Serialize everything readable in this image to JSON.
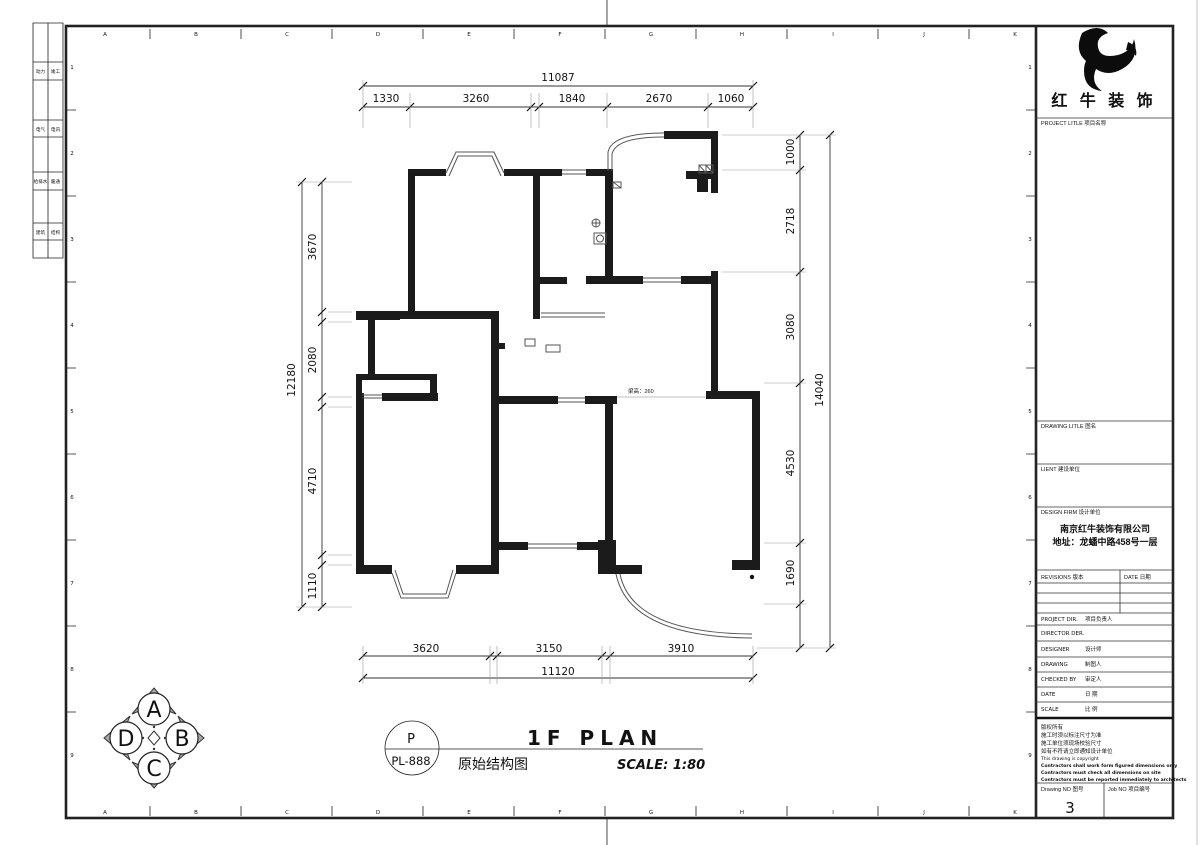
{
  "frame": {
    "letters": [
      "A",
      "B",
      "C",
      "D",
      "E",
      "F",
      "G",
      "H",
      "I",
      "J",
      "K"
    ],
    "rows": [
      "1",
      "2",
      "3",
      "4",
      "5",
      "6",
      "7",
      "8",
      "9"
    ],
    "strip": [
      [
        "动力",
        "竣工"
      ],
      [
        "电气",
        "电讯"
      ],
      [
        "给排水",
        "暖通"
      ],
      [
        "建筑",
        "结构"
      ]
    ]
  },
  "plan": {
    "beam_note": "梁高：260"
  },
  "dims": {
    "top": {
      "overall": "11087",
      "segments": [
        "1330",
        "3260",
        "1840",
        "2670",
        "1060"
      ]
    },
    "bottom": {
      "overall": "11120",
      "segments": [
        "3620",
        "3150",
        "3910"
      ]
    },
    "left": {
      "overall": "12180",
      "segments": [
        "3670",
        "2080",
        "4710",
        "1110"
      ]
    },
    "right": {
      "overall": "14040",
      "segments": [
        "1000",
        "2718",
        "3080",
        "4530",
        "1690"
      ]
    }
  },
  "titlebar": {
    "plan_title": "1F PLAN",
    "scale": "SCALE: 1:80",
    "drawing_name": "原始结构图",
    "tag_letter": "P",
    "tag_code": "PL-888"
  },
  "compass": {
    "labels": [
      "A",
      "B",
      "C",
      "D"
    ]
  },
  "titleblock": {
    "brand": "红 牛 装 饰",
    "project_label": "PROJECT LITLE  项目名称",
    "drawing_label": "DRAWING LITLE  图名",
    "client_label": "LIENT  建设单位",
    "design_firm_label": "DESIGN FIRM  设计单位",
    "firm_name": "南京红牛装饰有限公司",
    "firm_address": "地址：龙蟠中路458号一层",
    "revisions_label": "REVISIONS  版本",
    "rev_date_label": "DATE  日期",
    "fields": [
      {
        "en": "PROJECT DIR.",
        "zh": "项目负责人"
      },
      {
        "en": "DIRECTOR DER.",
        "zh": ""
      },
      {
        "en": "DESIGNER",
        "zh": "设计师"
      },
      {
        "en": "DRAWING",
        "zh": "制图人"
      },
      {
        "en": "CHECKED BY",
        "zh": "审定人"
      },
      {
        "en": "DATE",
        "zh": "日  期"
      },
      {
        "en": "SCALE",
        "zh": "比  例"
      }
    ],
    "copyright": [
      "版权所有",
      "施工时须以标注尺寸为准",
      "施工单位须现场校验尺寸",
      "如有不符请立即通知设计单位",
      "This drawing is copyright",
      "Contractors shall work form figured dimensions only",
      "Contractors must check all dimensions on site",
      "Contractors must be reported immediately to architects"
    ],
    "drawing_no_label": "Drawing NO  图号",
    "drawing_no": "3",
    "job_no_label": "Job NO  项目编号"
  }
}
